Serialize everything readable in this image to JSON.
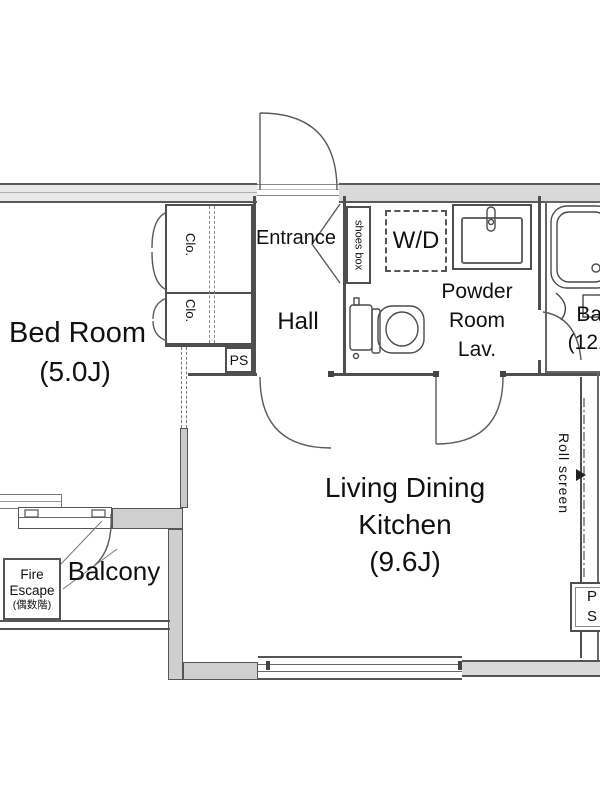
{
  "colors": {
    "wall_fill": "#d9d9d9",
    "line": "#4f4f4f",
    "text": "#111111"
  },
  "rooms": {
    "bedroom": {
      "name": "Bed Room",
      "size": "(5.0J)"
    },
    "living": {
      "line1": "Living Dining",
      "line2": "Kitchen",
      "size": "(9.6J)"
    },
    "entrance": {
      "label": "Entrance"
    },
    "hall": {
      "label": "Hall"
    },
    "powder": {
      "line1": "Powder",
      "line2": "Room",
      "line3": "Lav."
    },
    "bath": {
      "label": "Bath",
      "size": "(1216)"
    },
    "balcony": {
      "label": "Balcony"
    }
  },
  "fixtures": {
    "wd": {
      "label": "W/D"
    },
    "shoes_box": {
      "label": "shoes box"
    },
    "closet_top": {
      "label": "Clo."
    },
    "closet_bottom": {
      "label": "Clo."
    },
    "ps_upper": {
      "label": "PS"
    },
    "ps_lower": {
      "label": "PS"
    },
    "roll_screen": {
      "label": "Roll screen"
    },
    "fire_escape": {
      "line1": "Fire",
      "line2": "Escape",
      "line3": "(偶数階)"
    }
  }
}
